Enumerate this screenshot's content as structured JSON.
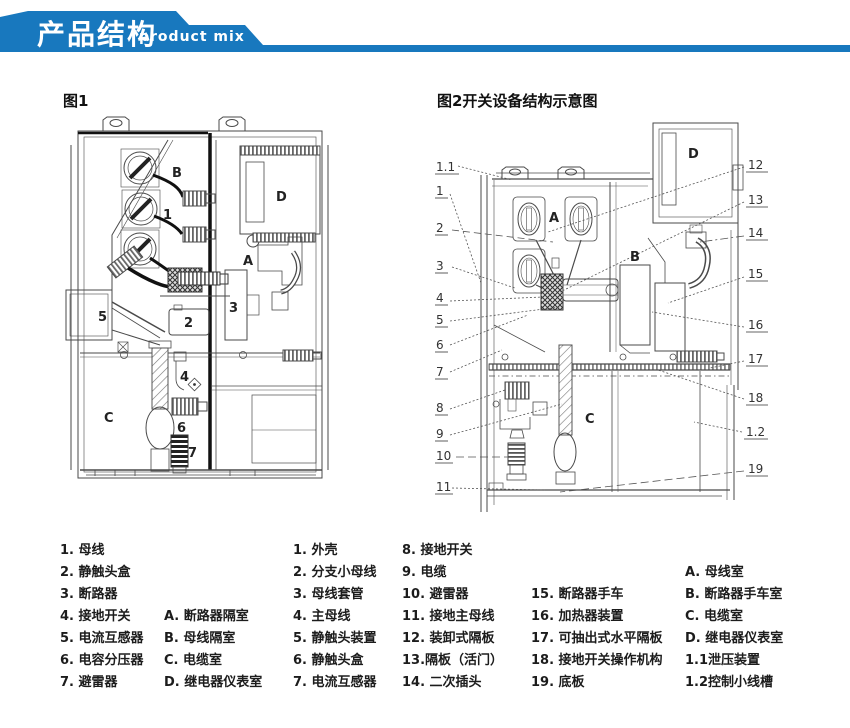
{
  "header": {
    "title": "产品结构",
    "subtitle": "product mix",
    "banner_color": "#1878be"
  },
  "figures": {
    "fig1": {
      "title": "图1",
      "labels": [
        {
          "t": "B"
        },
        {
          "t": "1"
        },
        {
          "t": "D"
        },
        {
          "t": "A"
        },
        {
          "t": "5"
        },
        {
          "t": "2"
        },
        {
          "t": "3"
        },
        {
          "t": "4"
        },
        {
          "t": "C"
        },
        {
          "t": "6"
        },
        {
          "t": "7"
        }
      ]
    },
    "fig2": {
      "title": "图2开关设备结构示意图",
      "left_callouts": [
        "1.1",
        "1",
        "2",
        "3",
        "4",
        "5",
        "6",
        "7",
        "8",
        "9",
        "10",
        "11"
      ],
      "right_callouts": [
        "12",
        "13",
        "14",
        "15",
        "16",
        "17",
        "18",
        "1.2",
        "19"
      ],
      "labels": [
        "D",
        "A",
        "B",
        "C"
      ]
    }
  },
  "legend": {
    "col1": [
      "1. 母线",
      "2. 静触头盒",
      "3. 断路器",
      "4. 接地开关",
      "5. 电流互感器",
      "6. 电容分压器",
      "7. 避雷器"
    ],
    "col1b": [
      "A. 断路器隔室",
      "B. 母线隔室",
      "C. 电缆室",
      "D. 继电器仪表室"
    ],
    "col2": [
      "1. 外壳",
      "2. 分支小母线",
      "3. 母线套管",
      "4. 主母线",
      "5. 静触头装置",
      "6. 静触头盒",
      "7. 电流互感器"
    ],
    "col3": [
      "8. 接地开关",
      "9. 电缆",
      "10. 避雷器",
      "11. 接地主母线",
      "12. 装卸式隔板",
      "13.隔板（活门）",
      "14. 二次插头"
    ],
    "col4": [
      "15. 断路器手车",
      "16. 加热器装置",
      "17. 可抽出式水平隔板",
      "18. 接地开关操作机构",
      "19. 底板"
    ],
    "col5": [
      "A. 母线室",
      "B. 断路器手车室",
      "C. 电缆室",
      "D. 继电器仪表室",
      "1.1泄压装置",
      "1.2控制小线槽"
    ]
  }
}
